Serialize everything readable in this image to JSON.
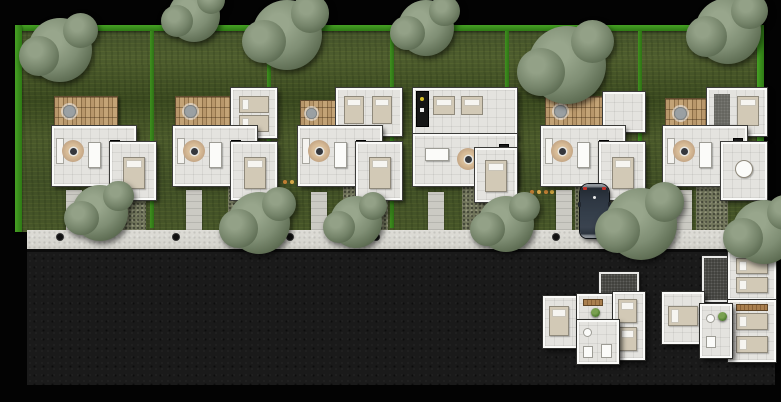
{
  "scene": {
    "type": "architectural-site-plan-rendering",
    "houses_count": 6,
    "detached_unit_plans_count": 2,
    "sidewalk_marker_count": 6,
    "tree_count": 12,
    "lots": [
      {
        "id": "lot-1",
        "house": "house-1",
        "wood_deck": true,
        "top_bedroom_wing": false,
        "car_parked": false
      },
      {
        "id": "lot-2",
        "house": "house-2",
        "wood_deck": true,
        "top_bedroom_wing": true,
        "car_parked": false
      },
      {
        "id": "lot-3",
        "house": "house-3",
        "wood_deck": true,
        "top_bedroom_wing": true,
        "car_parked": false
      },
      {
        "id": "lot-4",
        "house": "house-4",
        "wood_deck": false,
        "top_bedroom_wing": true,
        "car_parked": false
      },
      {
        "id": "lot-5",
        "house": "house-5",
        "wood_deck": true,
        "top_bedroom_wing": true,
        "car_parked": true
      },
      {
        "id": "lot-6",
        "house": "house-6",
        "wood_deck": true,
        "top_bedroom_wing": true,
        "car_parked": false
      }
    ],
    "car": {
      "location": "driveway-lot-5",
      "orientation": "rear-to-garden",
      "body_color": "#2e3742",
      "taillight_color": "#c03028"
    }
  },
  "colors": {
    "canvas-black": "#030303",
    "grass-base": "#47552a",
    "hedge-green": "#3b8a1e",
    "tree-sage": "#7f8e74",
    "deck-wood": "#b5946a",
    "floor-light": "#e4e3df",
    "wall-white": "#fafaf8",
    "bed-beige": "#d2c9b6",
    "rug-tan": "#c4a685",
    "counter-dark": "#191919",
    "sidewalk-gray": "#d9d8d2",
    "asphalt-dark": "#1a1a1a",
    "gravel": "#7e7d6b",
    "flower-orange": "#c07f35"
  }
}
